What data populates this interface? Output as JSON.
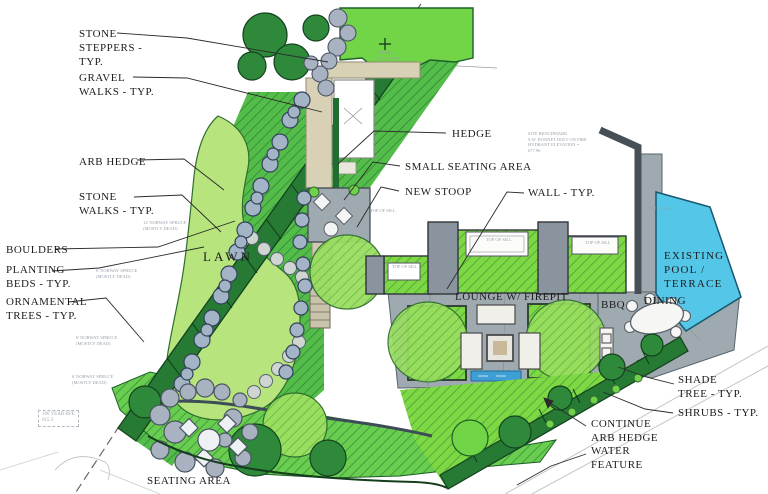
{
  "labels": {
    "stone_steppers": {
      "text": "STONE\nSTEPPERS -\nTYP."
    },
    "gravel_walks": {
      "text": "GRAVEL\nWALKS - TYP."
    },
    "arb_hedge": {
      "text": "ARB HEDGE"
    },
    "stone_walks": {
      "text": "STONE\nWALKS - TYP."
    },
    "boulders": {
      "text": "BOULDERS"
    },
    "planting_beds": {
      "text": "PLANTING\nBEDS - TYP."
    },
    "ornamental_trees": {
      "text": "ORNAMENTAL\nTREES - TYP."
    },
    "hedge": {
      "text": "HEDGE"
    },
    "small_seating_area": {
      "text": "SMALL SEATING AREA"
    },
    "new_stoop": {
      "text": "NEW STOOP"
    },
    "wall": {
      "text": "WALL - TYP."
    },
    "lawn": {
      "text": "LAWN"
    },
    "lounge": {
      "text": "LOUNGE W/ FIREPIT"
    },
    "bbq": {
      "text": "BBQ"
    },
    "dining": {
      "text": "DINING"
    },
    "existing_pool": {
      "text": "EXISTING\nPOOL /\nTERRACE"
    },
    "shade_tree": {
      "text": "SHADE\nTREE - TYP."
    },
    "shrubs": {
      "text": "SHRUBS - TYP."
    },
    "continue_arb_hedge": {
      "text": "CONTINUE\nARB HEDGE"
    },
    "water_feature": {
      "text": "WATER\nFEATURE"
    },
    "seating_area": {
      "text": "SEATING AREA"
    }
  },
  "annotations": {
    "site_benchmark": "SITE BENCHMARK\nS.W. BONNET BOLT ON FIRE\nHYDRANT ELEVATION =\n677.96",
    "bfe": "100 YEAR BFE\n615.3",
    "norway_6": "6' NORWAY SPRUCE\n(MOSTLY DEAD)",
    "norway_12": "12' NORWAY SPRUCE\n(MOSTLY DEAD)",
    "top_of_sill": "TOP OF SILL",
    "pear": "1 PEAR\n35' CANOPY"
  },
  "colors": {
    "hedge_dark": "#267a33",
    "bed_green": "#54bd4a",
    "bright_green": "#7ed843",
    "lawn": "#b7e47c",
    "terrace_gray": "#9fa9b0",
    "pool_cyan": "#54c7e8",
    "gravel": "#d8d1b6",
    "stone_gray": "#a8b2c0",
    "water_blue": "#3f9fd4"
  }
}
